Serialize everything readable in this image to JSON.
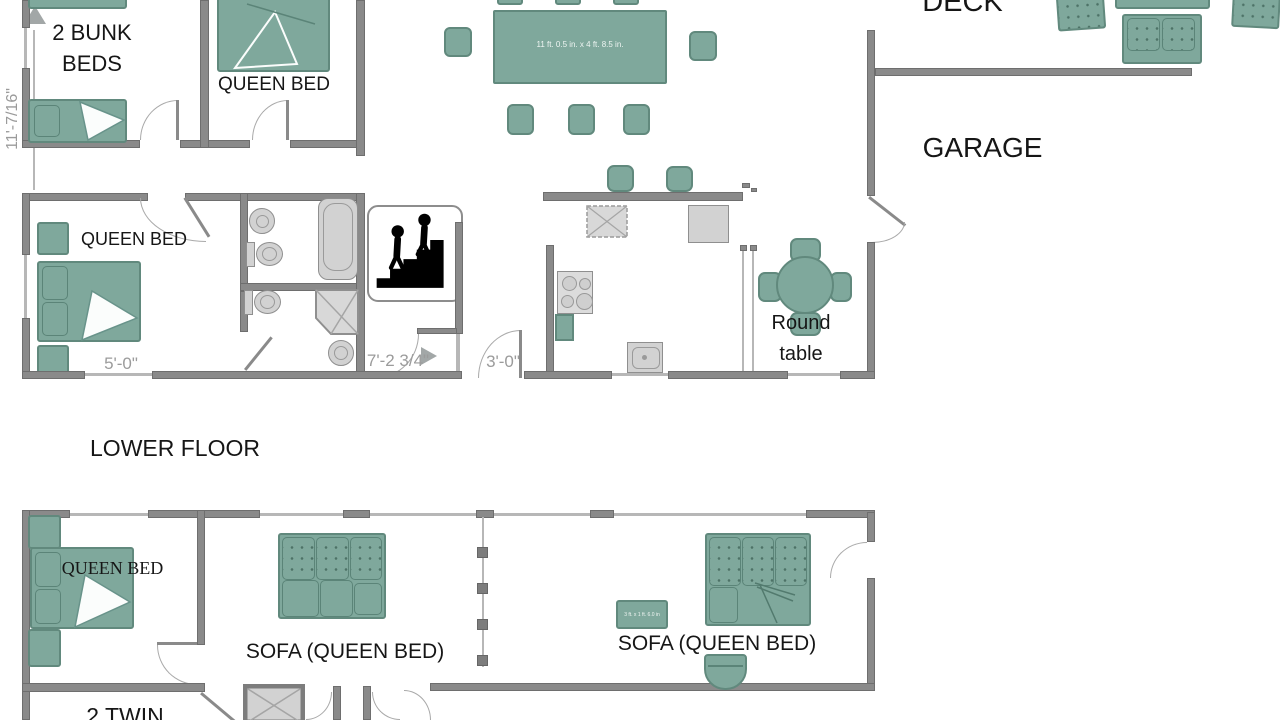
{
  "labels": {
    "bunk_beds": "2 BUNK\nBEDS",
    "queen_bed_upper": "QUEEN BED",
    "queen_bed_middle": "QUEEN BED",
    "deck": "DECK",
    "garage": "GARAGE",
    "round_table": "Round\ntable",
    "lower_floor": "LOWER FLOOR",
    "queen_bed_lower": "QUEEN BED",
    "sofa_queen_left": "SOFA (QUEEN BED)",
    "sofa_queen_right": "SOFA (QUEEN BED)",
    "twin_beds_partial": "2 TWIN"
  },
  "dimensions": {
    "left_wall_height": "11'-7/16\"",
    "dining_table_size": "11 ft. 0.5 in. x 4 ft. 8.5 in.",
    "middle_room_width": "5'-0\"",
    "hallway_width": "7'-2 3/4\"",
    "door_width": "3'-0\"",
    "bench_size": "3 ft. x 1 ft. 6.0 in"
  },
  "icons": {
    "stairs": "stairs-up-icon",
    "dim_arrow_up": "dimension-arrow-up-icon",
    "dim_arrow_right": "dimension-arrow-right-icon"
  },
  "colors": {
    "furniture": "#7FA89C",
    "furniture_border": "#61897D",
    "wall": "#8A8A8A",
    "fixture": "#D2D2D2",
    "dimension_text": "#9B9B9B",
    "label_text": "#161616"
  }
}
